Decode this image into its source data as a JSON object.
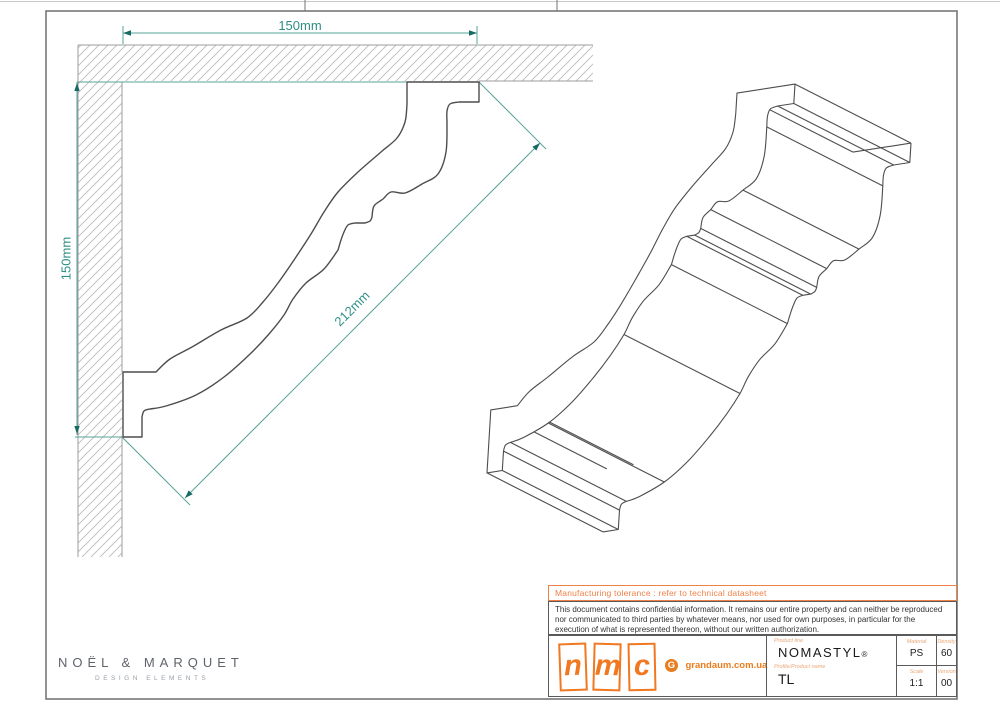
{
  "dimensions": {
    "top": "150mm",
    "side": "150mm",
    "diagonal": "212mm"
  },
  "title_block": {
    "tolerance_note": "Manufacturing tolerance : refer to technical datasheet",
    "confidential_text": "This document contains confidential information. It remains our entire property and can neither be reproduced nor communicated to third parties by whatever means, nor used for own purposes, in particular for the execution of what is represented thereon, without our written authorization.",
    "manufacturer_logo_letters": [
      "n",
      "m",
      "c"
    ],
    "partner": {
      "initial": "G",
      "site": "grandaum.com.ua"
    },
    "product": {
      "line_label": "Product line",
      "line": "NOMASTYL",
      "registered": "®",
      "name_label": "Profile/Product name",
      "name": "TL"
    },
    "specs": {
      "material_label": "Material",
      "material": "PS",
      "density_label": "Density",
      "density": "60",
      "scale_label": "Scale",
      "scale": "1:1",
      "version_label": "Version",
      "version": "00"
    }
  },
  "brand": {
    "name": "NOËL & MARQUET",
    "tagline": "DESIGN ELEMENTS"
  },
  "colors": {
    "teal_line": "#5aa39b",
    "teal_text": "#2f8f86",
    "teal_arrow": "#156a62",
    "profile_line": "#4d4d4d",
    "hatch": "#bcbcbc",
    "structure": "#9c9c9c",
    "frame": "#777777",
    "orange": "#f07820"
  }
}
